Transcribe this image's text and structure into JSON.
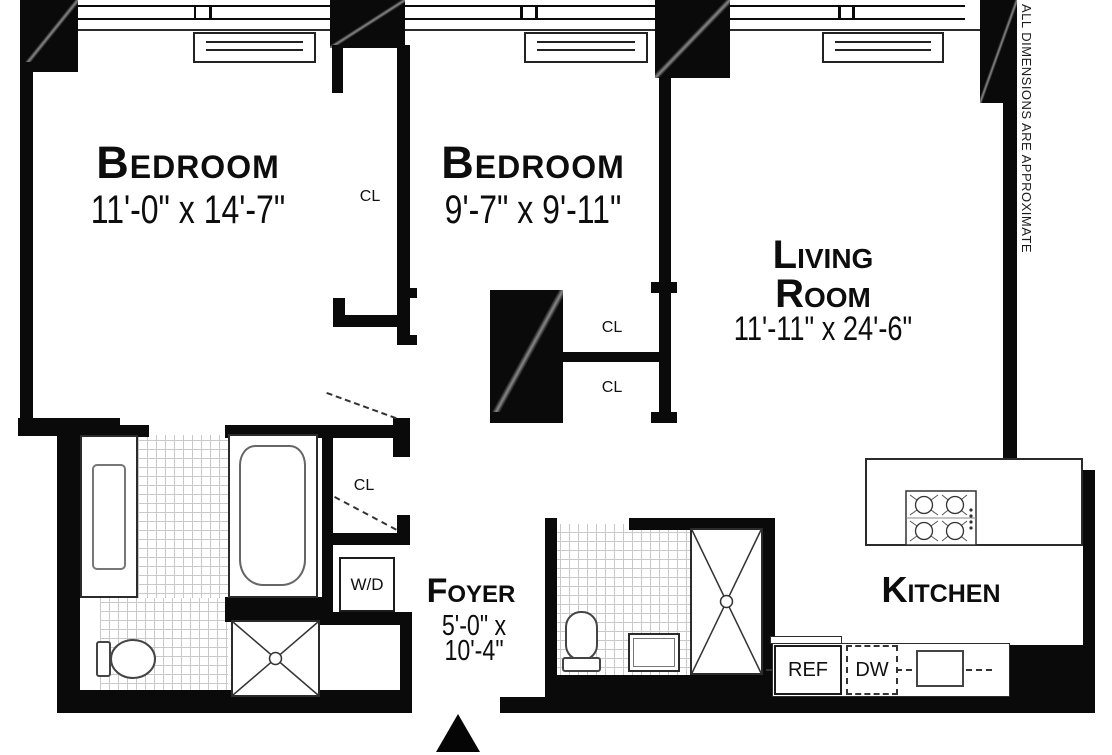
{
  "plan": {
    "disclaimer": "ALL DIMENSIONS ARE APPROXIMATE",
    "rooms": {
      "bedroom1": {
        "name": "Bedroom",
        "dims": "11'-0\" x 14'-7\""
      },
      "bedroom2": {
        "name": "Bedroom",
        "dims": "9'-7\" x 9'-11\""
      },
      "living": {
        "name_line1": "Living",
        "name_line2": "Room",
        "dims": "11'-11\" x 24'-6\""
      },
      "kitchen": {
        "name": "Kitchen"
      },
      "foyer": {
        "name": "Foyer",
        "dims_line1": "5'-0\" x",
        "dims_line2": "10'-4\""
      }
    },
    "closets": [
      {
        "label": "CL"
      },
      {
        "label": "CL"
      },
      {
        "label": "CL"
      },
      {
        "label": "CL"
      }
    ],
    "appliances": {
      "washer_dryer": "W/D",
      "refrigerator": "REF",
      "dishwasher": "DW"
    },
    "colors": {
      "wall": "#0a0a0a",
      "background": "#ffffff",
      "fixture_line": "#555555",
      "tile_line": "#c9c9c9"
    }
  }
}
